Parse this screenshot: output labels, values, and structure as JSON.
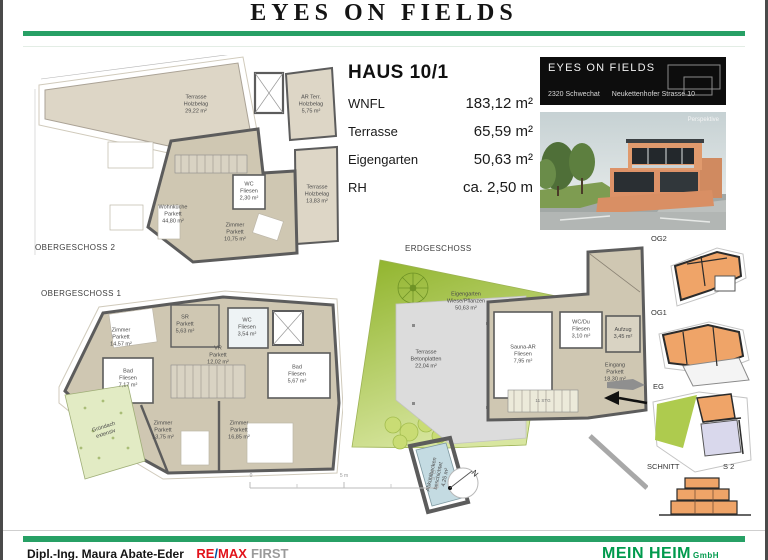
{
  "header": {
    "title": "EYES ON FIELDS"
  },
  "info": {
    "title": "HAUS 10/1",
    "rows": [
      {
        "label": "WNFL",
        "value": "183,12 m²"
      },
      {
        "label": "Terrasse",
        "value": "65,59 m²"
      },
      {
        "label": "Eigengarten",
        "value": "50,63 m²"
      },
      {
        "label": "RH",
        "value": "ca. 2,50 m"
      }
    ]
  },
  "project_box": {
    "name": "EYES ON FIELDS",
    "city": "2320 Schwechat",
    "street": "Neukettenhofer Strasse 10"
  },
  "perspective": {
    "caption": "Perspektive"
  },
  "plans": {
    "og2": {
      "title": "OBERGESCHOSS 2",
      "rooms": {
        "terrasse_top": "Terrasse\nHolzbelag\n29,22 m²",
        "ar_terr": "AR Terr.\nHolzbelag\n5,75 m²",
        "terrasse_right": "Terrasse\nHolzbelag\n13,83 m²",
        "wohnkueche": "Wohnküche\nParkett\n44,80 m²",
        "wc": "WC\nFliesen\n2,30 m²",
        "zimmer": "Zimmer\nParkett\n10,75 m²"
      }
    },
    "og1": {
      "title": "OBERGESCHOSS 1",
      "rooms": {
        "zimmer_nw": "Zimmer\nParkett\n14,57 m²",
        "sr": "SR\nParkett\n5,63 m²",
        "wc": "WC\nFliesen\n3,54 m²",
        "vr": "VR\nParkett\n12,02 m²",
        "bad_west": "Bad\nFliesen\n7,17 m²",
        "bad_ost": "Bad\nFliesen\n5,67 m²",
        "zimmer_sw": "Zimmer\nParkett\n13,75 m²",
        "zimmer_so": "Zimmer\nParkett\n16,85 m²",
        "gruendach": "Gründach\nextensiv"
      }
    },
    "eg": {
      "title": "ERDGESCHOSS",
      "rooms": {
        "eigengarten": "Eigengarten\nWiese/Pflanzen\n50,63 m²",
        "terrasse": "Terrasse\nBetonplatten\n22,04 m²",
        "sauna": "Sauna-AR\nFliesen\n7,95 m²",
        "wcdu": "WC/Du\nFliesen\n3,10 m²",
        "aufzug": "Aufzug\n3,45 m²",
        "eingang": "Eingang\nParkett\n18,30 m²",
        "stiege": "11 STG",
        "pool": "Abkühlbecken\nbeschichtet\n4,25 m²"
      }
    }
  },
  "scalebar": {
    "zero": "0",
    "five": "5 m",
    "ten": "10 m"
  },
  "north": {
    "label": "N"
  },
  "side_plans": {
    "og2": "OG2",
    "og1": "OG1",
    "eg": "EG",
    "schnitt": "SCHNITT",
    "schnitt_nr": "S 2"
  },
  "footer": {
    "agent": "Dipl.-Ing. Maura Abate-Eder",
    "brand_re": "RE",
    "brand_slash": "/",
    "brand_max": "MAX",
    "brand_suffix": "FIRST",
    "company": "MEIN HEIM",
    "company_suffix": "GmbH"
  },
  "colors": {
    "accent_green": "#27a065",
    "remax_red": "#e2131b",
    "meinheim_green": "#009a4d",
    "plan_interior": "#cfc7b2",
    "plan_terrace": "#ddd6c6",
    "garden_green": "#9aba3a",
    "thumb_orange": "#efa468"
  }
}
